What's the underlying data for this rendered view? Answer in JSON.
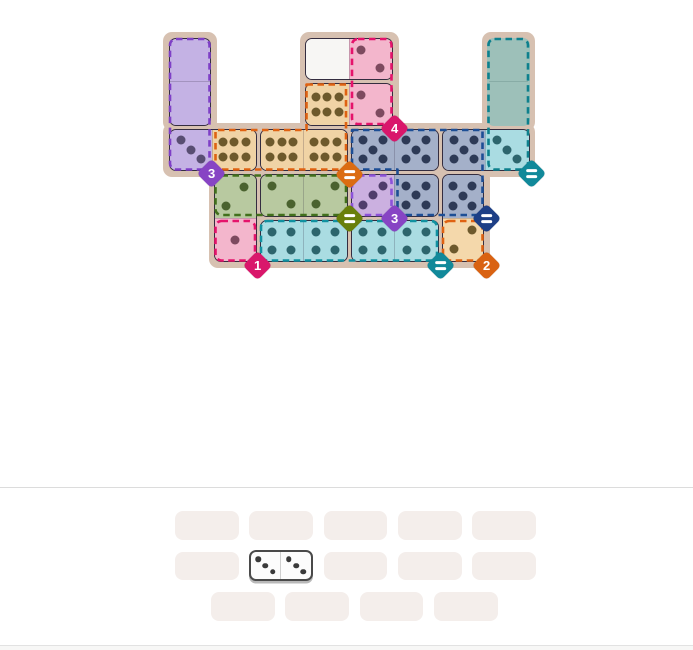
{
  "board": {
    "origin_x": 167,
    "origin_y": 36,
    "cell_size": 45.5,
    "piece_inset": 1.5,
    "background_color": "#d7c1b1",
    "bg_patches": [
      {
        "x": 163,
        "y": 32,
        "w": 53.5,
        "h": 99
      },
      {
        "x": 299.5,
        "y": 32,
        "w": 99,
        "h": 99
      },
      {
        "x": 481.5,
        "y": 32,
        "w": 53.5,
        "h": 99
      },
      {
        "x": 163,
        "y": 123,
        "w": 372,
        "h": 53.5
      },
      {
        "x": 208.5,
        "y": 168.5,
        "w": 281,
        "h": 99
      }
    ],
    "palette": {
      "purple": {
        "fill": "#c4b2e4",
        "pip": "#584d72"
      },
      "pink": {
        "fill": "#f3b6cc",
        "pip": "#7d4a5f"
      },
      "tan": {
        "fill": "#f0d3a5",
        "pip": "#6d592c"
      },
      "blue": {
        "fill": "#a4b0c9",
        "pip": "#2e3a56"
      },
      "cyan": {
        "fill": "#aadce2",
        "pip": "#2d656d"
      },
      "green": {
        "fill": "#b8c9a0",
        "pip": "#4a622f"
      },
      "lavender": {
        "fill": "#cbb0e0",
        "pip": "#4f3d6b"
      },
      "white": {
        "fill": "#f7f6f4",
        "pip": "#444444"
      },
      "tan2": {
        "fill": "#f4d8ab",
        "pip": "#6d592c"
      }
    },
    "pieces": [
      {
        "cells": [
          [
            1,
            1
          ],
          [
            1,
            2
          ]
        ],
        "pips": [
          0,
          0
        ],
        "colors": [
          "purple",
          "purple"
        ],
        "variants": [
          "a",
          "a"
        ]
      },
      {
        "cells": [
          [
            4,
            1
          ],
          [
            5,
            1
          ]
        ],
        "pips": [
          0,
          2
        ],
        "colors": [
          "white",
          "pink"
        ],
        "variants": [
          "a",
          "a"
        ]
      },
      {
        "cells": [
          [
            4,
            2
          ],
          [
            5,
            2
          ]
        ],
        "pips": [
          6,
          2
        ],
        "colors": [
          "tan",
          "pink"
        ],
        "variants": [
          "a",
          "a"
        ]
      },
      {
        "cells": [
          [
            1,
            3
          ],
          [
            2,
            3
          ]
        ],
        "pips": [
          3,
          6
        ],
        "colors": [
          "purple",
          "tan"
        ],
        "variants": [
          "a",
          "a"
        ]
      },
      {
        "cells": [
          [
            3,
            3
          ],
          [
            4,
            3
          ]
        ],
        "pips": [
          6,
          6
        ],
        "colors": [
          "tan",
          "tan"
        ],
        "variants": [
          "a",
          "a"
        ]
      },
      {
        "cells": [
          [
            5,
            3
          ],
          [
            6,
            3
          ]
        ],
        "pips": [
          5,
          5
        ],
        "colors": [
          "blue",
          "blue"
        ],
        "variants": [
          "a",
          "a"
        ]
      },
      {
        "cells": [
          [
            7,
            3
          ],
          [
            8,
            3
          ]
        ],
        "pips": [
          5,
          3
        ],
        "colors": [
          "blue",
          "cyan"
        ],
        "variants": [
          "a",
          "a"
        ]
      },
      {
        "cells": [
          [
            2,
            4
          ],
          [
            2,
            5
          ]
        ],
        "pips": [
          2,
          1
        ],
        "colors": [
          "green",
          "pink"
        ],
        "variants": [
          "b",
          "a"
        ]
      },
      {
        "cells": [
          [
            3,
            4
          ],
          [
            4,
            4
          ]
        ],
        "pips": [
          2,
          2
        ],
        "colors": [
          "green",
          "green"
        ],
        "variants": [
          "a",
          "b"
        ]
      },
      {
        "cells": [
          [
            5,
            4
          ],
          [
            6,
            4
          ]
        ],
        "pips": [
          3,
          5
        ],
        "colors": [
          "lavender",
          "blue"
        ],
        "variants": [
          "b",
          "a"
        ]
      },
      {
        "cells": [
          [
            7,
            4
          ],
          [
            7,
            5
          ]
        ],
        "pips": [
          5,
          2
        ],
        "colors": [
          "blue",
          "tan2"
        ],
        "variants": [
          "a",
          "b"
        ]
      },
      {
        "cells": [
          [
            3,
            5
          ],
          [
            4,
            5
          ]
        ],
        "pips": [
          4,
          4
        ],
        "colors": [
          "cyan",
          "cyan"
        ],
        "variants": [
          "a",
          "a"
        ]
      },
      {
        "cells": [
          [
            5,
            5
          ],
          [
            6,
            5
          ]
        ],
        "pips": [
          4,
          4
        ],
        "colors": [
          "cyan",
          "cyan"
        ],
        "variants": [
          "a",
          "a"
        ]
      }
    ],
    "empty_regions": [
      {
        "cells": [
          [
            8,
            1
          ],
          [
            8,
            2
          ]
        ],
        "fill": "#9dc0b9"
      }
    ],
    "region_border_rects": [
      {
        "region": "purple-sum-3",
        "color": "#7e3fc6",
        "x": 170,
        "y": 39,
        "w": 39.5,
        "h": 130.5
      },
      {
        "region": "pink-sum-4",
        "color": "#e5136b",
        "x": 352,
        "y": 39,
        "w": 39.5,
        "h": 85
      },
      {
        "region": "teal-equal",
        "color": "#0d808d",
        "x": 488.5,
        "y": 39,
        "w": 39.5,
        "h": 130.5
      },
      {
        "region": "green-equal",
        "color": "#42701c",
        "x": 215.5,
        "y": 175.5,
        "w": 130.5,
        "h": 39.5
      },
      {
        "region": "lavender-sum-3",
        "color": "#8d52d9",
        "x": 352,
        "y": 175.5,
        "w": 39.5,
        "h": 39.5
      },
      {
        "region": "pink-sum-1",
        "color": "#e5136b",
        "x": 215.5,
        "y": 221,
        "w": 39.5,
        "h": 39.5
      },
      {
        "region": "cyan-equal",
        "color": "#1191a0",
        "x": 261,
        "y": 221,
        "w": 176,
        "h": 39.5
      },
      {
        "region": "orange-sum-2",
        "color": "#df6212",
        "x": 443,
        "y": 221,
        "w": 39.5,
        "h": 39.5
      }
    ],
    "region_border_polys": [
      {
        "region": "orange-equal",
        "color": "#df6212",
        "points": "306.5,84.5 346,84.5 346,169.5 215.5,169.5 215.5,130 306.5,130"
      },
      {
        "region": "blue-equal",
        "color": "#1d4e95",
        "points": "352,130 482.5,130 482.5,215 397.5,215 397.5,169.5 352,169.5"
      }
    ],
    "badges": [
      {
        "x": 211,
        "y": 173,
        "color": "#8744c4",
        "label": "3"
      },
      {
        "x": 394,
        "y": 128,
        "color": "#d9176b",
        "label": "4"
      },
      {
        "x": 349,
        "y": 174,
        "color": "#db6c12",
        "label": "="
      },
      {
        "x": 531,
        "y": 173,
        "color": "#11899a",
        "label": "="
      },
      {
        "x": 349,
        "y": 218,
        "color": "#697f0a",
        "label": "="
      },
      {
        "x": 394,
        "y": 218,
        "color": "#8744c4",
        "label": "3"
      },
      {
        "x": 486,
        "y": 218,
        "color": "#1d3f86",
        "label": "="
      },
      {
        "x": 257,
        "y": 265,
        "color": "#d9176b",
        "label": "1"
      },
      {
        "x": 440,
        "y": 265,
        "color": "#11899a",
        "label": "="
      },
      {
        "x": 486,
        "y": 265,
        "color": "#d96212",
        "label": "2"
      }
    ]
  },
  "tray": {
    "slot": {
      "w": 63.7,
      "h": 28.6,
      "fill": "#f4eeeb"
    },
    "rows": [
      {
        "y": 511,
        "xs": [
          175,
          249.3,
          323.6,
          397.9,
          472.2
        ]
      },
      {
        "y": 551.5,
        "xs": [
          175,
          249.3,
          323.6,
          397.9,
          472.2
        ]
      },
      {
        "y": 592,
        "xs": [
          211,
          285.3,
          359.6,
          433.9
        ]
      }
    ],
    "remaining_domino": {
      "x": 248.5,
      "y": 550,
      "w": 64.5,
      "h": 31,
      "pips": [
        3,
        3
      ],
      "pip_color": "#3a3a3a",
      "variants": [
        "a",
        "a"
      ]
    }
  }
}
